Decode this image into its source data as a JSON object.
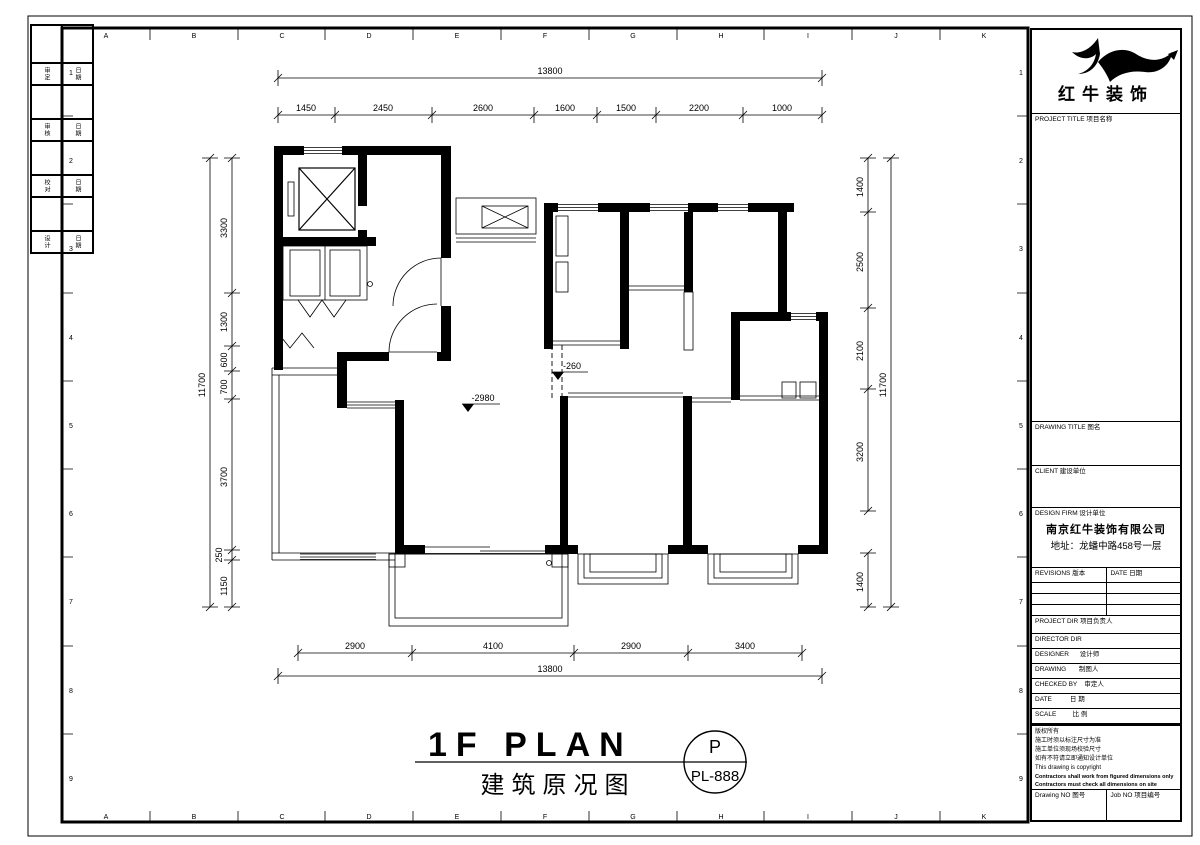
{
  "frame": {
    "grid_letters": [
      "A",
      "B",
      "C",
      "D",
      "E",
      "F",
      "G",
      "H",
      "I",
      "J",
      "K"
    ],
    "grid_numbers": [
      "1",
      "2",
      "3",
      "4",
      "5",
      "6",
      "7",
      "8",
      "9"
    ]
  },
  "logo": {
    "company_name": "红牛装饰"
  },
  "side_strip": {
    "rows": [
      [
        "审定",
        "日期"
      ],
      [
        "审核",
        "日期"
      ],
      [
        "校对",
        "日期"
      ],
      [
        "设计",
        "日期"
      ]
    ]
  },
  "dims": {
    "top": {
      "total": "13800",
      "segs": [
        "1450",
        "2450",
        "2600",
        "1600",
        "1500",
        "2200",
        "1000"
      ]
    },
    "bottom": {
      "total": "13800",
      "segs": [
        "2900",
        "4100",
        "2900",
        "3400"
      ]
    },
    "left": {
      "total": "11700",
      "segs": [
        "3300",
        "1300",
        "600",
        "700",
        "3700",
        "250",
        "1150"
      ]
    },
    "right": {
      "total": "11700",
      "segs": [
        "1400",
        "2500",
        "2100",
        "3200",
        "1400"
      ]
    }
  },
  "marks": {
    "living_elevation": "-2980",
    "hall_elevation": "-260"
  },
  "title_area": {
    "main": "1F PLAN",
    "sub": "建筑原况图",
    "stamp_letter": "P",
    "stamp_code": "PL-888"
  },
  "titleblock": {
    "project_title_label": "PROJECT TITLE  项目名称",
    "drawing_title_label": "DRAWING TITLE  图名",
    "client_label": "CLIENT  建设单位",
    "design_firm_label": "DESIGN FIRM  设计单位",
    "design_firm_name": "南京红牛装饰有限公司",
    "design_firm_address": "地址：龙蟠中路458号一层",
    "revisions_label": "REVISIONS  版本",
    "date_col_label": "DATE  日期",
    "project_dir_label": "PROJECT DIR  项目负责人",
    "director_label": "DIRECTOR DIR",
    "designer_label": "DESIGNER      设计师",
    "drawing_label": "DRAWING       制图人",
    "checked_label": "CHECKED BY    审定人",
    "date_label": "DATE          日 期",
    "scale_label": "SCALE         比 例",
    "copyright_lines": [
      "版权所有",
      "施工时须以标注尺寸为准",
      "施工单位须现场校验尺寸",
      "如有不符请立即通知设计单位",
      "This drawing is copyright"
    ],
    "copyright_bold_1": "Contractors shall work from figured dimensions only",
    "copyright_bold_2": "Contractors must check all dimensions on site",
    "copyright_bold_3": "Discrepancies must be reported immediately to architects",
    "drawing_no_label": "Drawing NO  图号",
    "job_no_label": "Job NO  项目编号"
  }
}
